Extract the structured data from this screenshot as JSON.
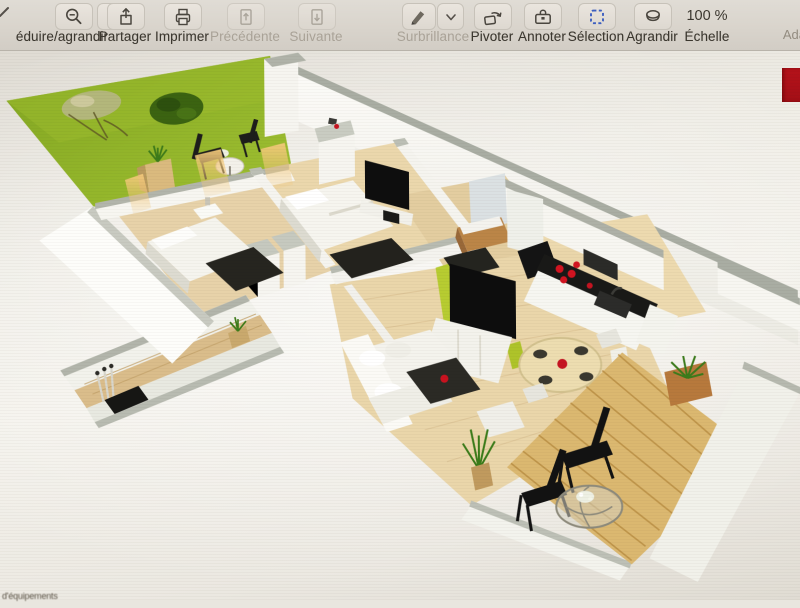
{
  "app": {
    "toolbar": {
      "zoom_group": {
        "label": "éduire/agrandir",
        "zoom_out_icon": "magnifier-minus-icon",
        "zoom_in_icon": "magnifier-plus-icon"
      },
      "buttons": [
        {
          "id": "share",
          "label": "Partager",
          "icon": "share-icon",
          "enabled": true
        },
        {
          "id": "print",
          "label": "Imprimer",
          "icon": "printer-icon",
          "enabled": true
        },
        {
          "id": "previous",
          "label": "Précédente",
          "icon": "page-up-icon",
          "enabled": false
        },
        {
          "id": "next",
          "label": "Suivante",
          "icon": "page-down-icon",
          "enabled": false
        },
        {
          "id": "highlight",
          "label": "Surbrillance",
          "icon": "highlighter-icon",
          "enabled": false,
          "has_dropdown": true
        },
        {
          "id": "rotate",
          "label": "Pivoter",
          "icon": "rotate-left-icon",
          "enabled": true
        },
        {
          "id": "annotate",
          "label": "Annoter",
          "icon": "toolbox-icon",
          "enabled": true
        },
        {
          "id": "selection",
          "label": "Sélection",
          "icon": "selection-dashed-rect-icon",
          "enabled": true
        },
        {
          "id": "magnify",
          "label": "Agrandir",
          "icon": "loupe-icon",
          "enabled": true
        }
      ],
      "scale": {
        "value": "100 %",
        "label": "Échelle"
      },
      "right_truncated_label": "Ada"
    }
  },
  "document": {
    "type": "floor-plan-3d-render",
    "bottom_left_truncated_text": "d'équipements",
    "red_badge_color": "#b5121a",
    "floor_plan_colors": {
      "lawn_green": "#8fb02c",
      "bush_green": "#3f6617",
      "accent_lime": "#b7cb36",
      "wood_floor": "#e6d2ab",
      "deck_wood": "#d9b572",
      "wall_white": "#f9f8f4",
      "wall_cap_gray": "#a9ada3",
      "dark_furniture": "#1c1c1a",
      "red_accent": "#c41420",
      "window_glow": "#eec27a"
    }
  }
}
